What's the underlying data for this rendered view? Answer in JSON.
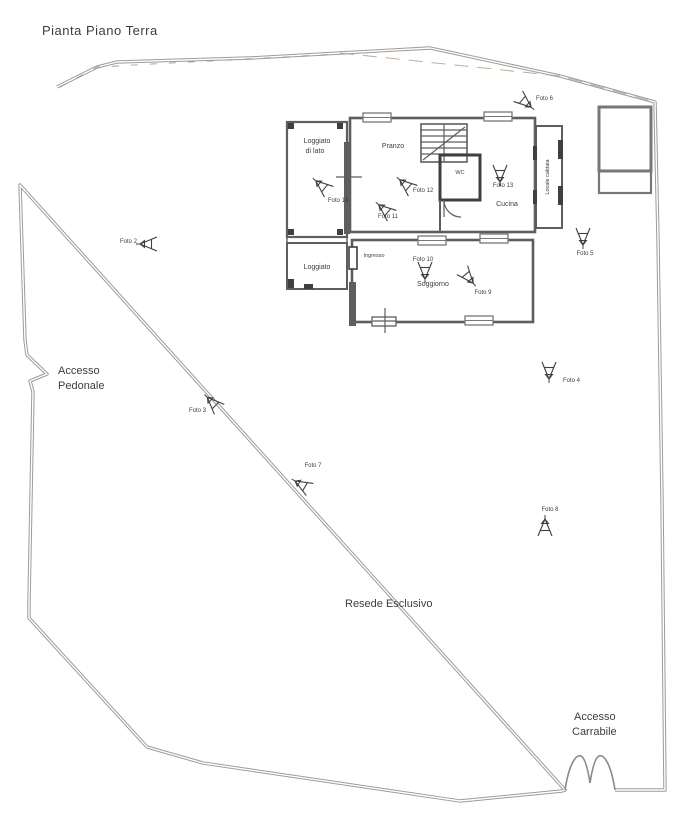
{
  "title": "Pianta Piano Terra",
  "areas": {
    "accesso_pedonale_line1": "Accesso",
    "accesso_pedonale_line2": "Pedonale",
    "resede_esclusivo": "Resede Esclusivo",
    "accesso_carrabile_line1": "Accesso",
    "accesso_carrabile_line2": "Carrabile"
  },
  "rooms": {
    "loggiato_lato_line1": "Loggiato",
    "loggiato_lato_line2": "di lato",
    "pranzo": "Pranzo",
    "wc": "WC",
    "cucina": "Cucina",
    "locale_caldaia": "Locale caldaia",
    "loggiato": "Loggiato",
    "ingresso": "Ingresso",
    "soggiorno": "Soggiorno"
  },
  "photos": {
    "foto2": "Foto 2",
    "foto3": "Foto 3",
    "foto4": "Foto 4",
    "foto5": "Foto 5",
    "foto6": "Foto 6",
    "foto7": "Foto 7",
    "foto8": "Foto 8",
    "foto9": "Foto 9",
    "foto10": "Foto 10",
    "foto11": "Foto 11",
    "foto12": "Foto 12",
    "foto13": "Foto 13",
    "foto14": "Foto 14"
  },
  "icons": {
    "marker": "camera-viewpoint-marker"
  },
  "colors": {
    "wall": "#5e5e5e",
    "wall_dark": "#3f3f3f",
    "boundary": "#9b9b9b",
    "text": "#3d3d3d",
    "boundary_tint_blue": "#7d8fc0",
    "boundary_tint_tan": "#b5997d"
  }
}
